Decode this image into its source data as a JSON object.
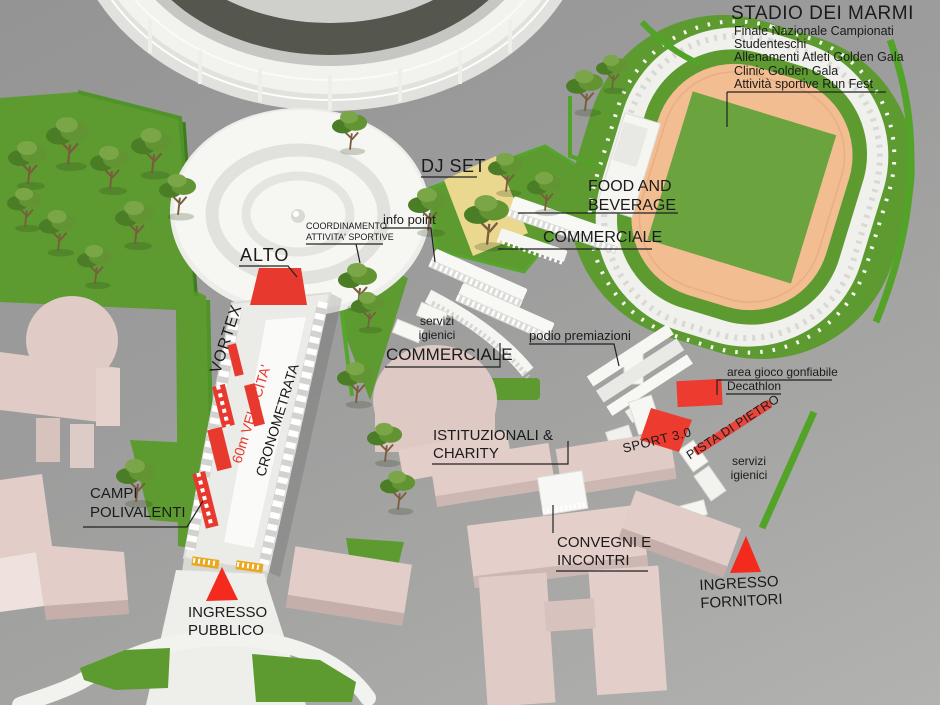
{
  "labels": {
    "stadio_dei_marmi": {
      "title": "STADIO DEI MARMI",
      "lines": [
        "Finale Nazionale Campionati",
        "Studenteschi",
        "Allenamenti Atleti Golden Gala",
        "Clinic Golden Gala",
        "Attività sportive Run Fest"
      ]
    },
    "dj_set": "DJ SET",
    "food_and_beverage": [
      "FOOD AND",
      "BEVERAGE"
    ],
    "commerciale_stadio": "COMMERCIALE",
    "commerciale_village": "COMMERCIALE",
    "info_point": "info point",
    "coordinamento": [
      "COORDINAMENTO",
      "ATTIVITA' SPORTIVE"
    ],
    "alto": "ALTO",
    "vortex": "VORTEX",
    "velocita_60m": "60m VELOCITA'",
    "cronometrata": "CRONOMETRATA",
    "servizi_igienici": [
      "servizi",
      "igienici"
    ],
    "podio_premiazioni": "podio premiazioni",
    "area_gioco_gonfiabile": "area gioco gonfiabile",
    "decathlon": "Decathlon",
    "sport_30": "SPORT 3.0",
    "pista_di_pietro": "PISTA DI PIETRO",
    "istituzionali": [
      "ISTITUZIONALI &",
      "CHARITY"
    ],
    "convegni": [
      "CONVEGNI E",
      "INCONTRI"
    ],
    "ingresso_pubblico": [
      "INGRESSO",
      "PUBBLICO"
    ],
    "ingresso_fornitori": [
      "INGRESSO",
      "FORNITORI"
    ],
    "campi_polivalenti": [
      "CAMPI",
      "POLIVALENTI"
    ]
  },
  "colors": {
    "accent_red": "#ee3b30",
    "entrance_red": "#f42a1e",
    "lawn_green": "#5d9b31",
    "hedge_green": "#52a328",
    "infield_green": "#6ba33e",
    "track_tan": "#f3bd92",
    "building_pink": "#e2cdc8",
    "sand_yellow": "#ead88f",
    "gate_yellow": "#e9a81f",
    "background_grey": "#9b9b9b"
  }
}
